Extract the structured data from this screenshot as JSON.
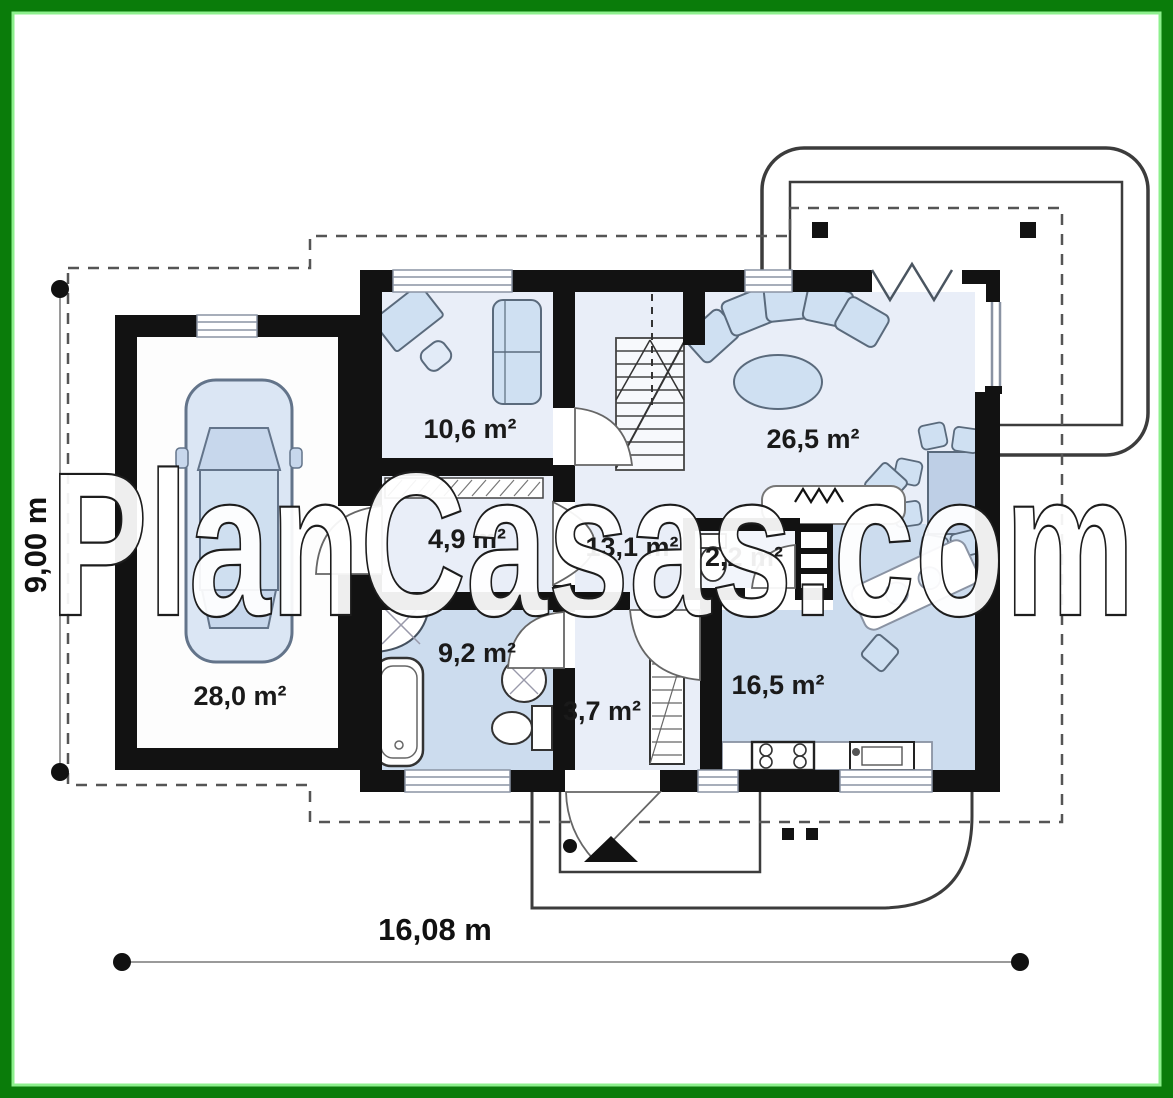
{
  "watermark": "PlanCasas.com",
  "dimensions": {
    "width": "16,08 m",
    "height": "9,00 m"
  },
  "rooms": {
    "garage": "28,0 m²",
    "office": "10,6 m²",
    "corridor": "4,9 m²",
    "hall": "13,1 m²",
    "wc": "2,2 m²",
    "bathroom": "9,2 m²",
    "vestibule": "3,7 m²",
    "kitchen": "16,5 m²",
    "living_room": "26,5 m²"
  },
  "colors": {
    "frame_green": "#0a7c0a",
    "frame_green_light": "#8df08d",
    "wall_black": "#121212",
    "floor_light_blue": "#e9eef8",
    "floor_medium_blue": "#ccdcee",
    "furniture_blue": "#cfe0f2"
  }
}
